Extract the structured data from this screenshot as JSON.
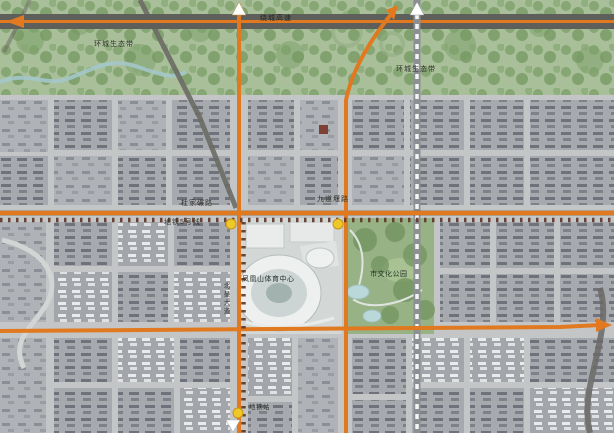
{
  "map": {
    "labels": {
      "eco_belt_left": "环城生态带",
      "ring_expressway": "绕城高速",
      "eco_belt_right": "环城生态带",
      "dujianian_road": "杜家碾路",
      "jiudaoyan_road": "九道堰路",
      "metro_line5": "地铁5号线",
      "beixing_avenue": "北星大道",
      "sports_center": "凤凰山体育中心",
      "culture_park": "市文化公园",
      "metro_station": "地铁站"
    },
    "colors": {
      "road_orange": "#e0791f",
      "metro_dash": "#5e3526",
      "station_yellow": "#eec829",
      "eco_green": "#a9bf9a",
      "park_green": "#97b284",
      "highway_gray": "#5e5f5a",
      "city_gray": "#b4b7bb",
      "planned_road_dash": "#f4f5f5"
    }
  }
}
